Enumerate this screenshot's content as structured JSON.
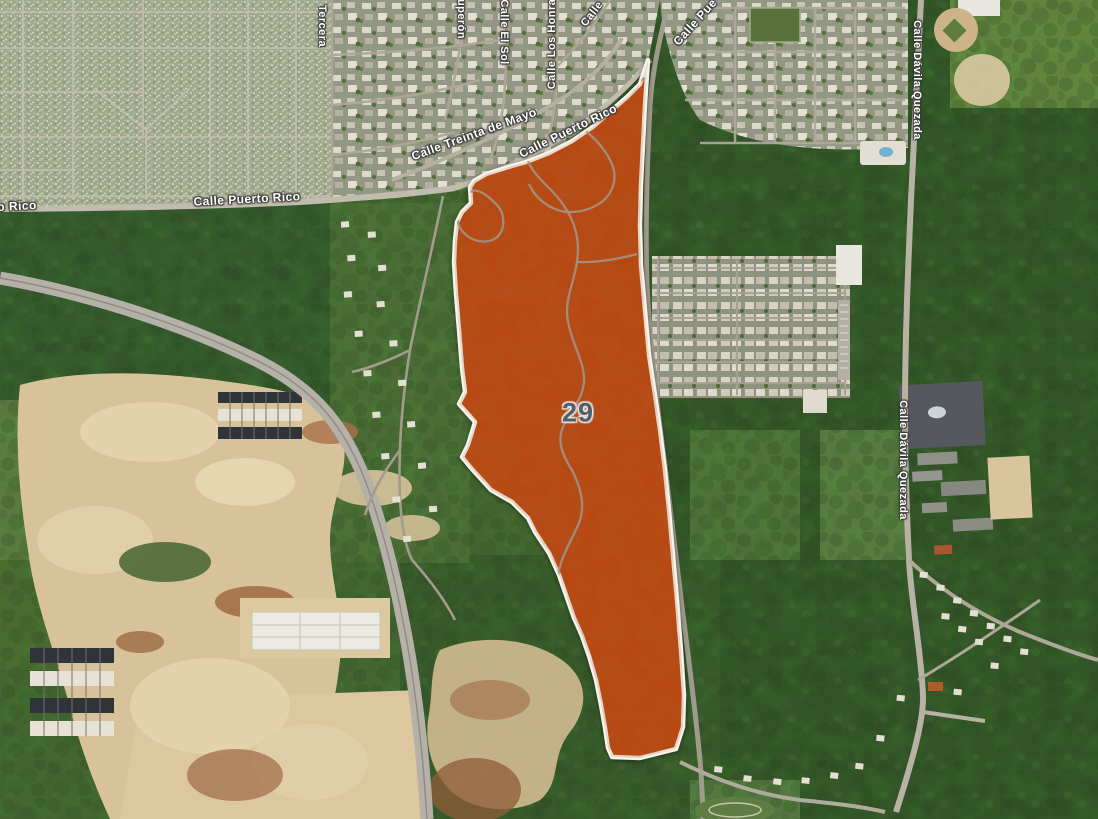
{
  "map": {
    "type": "satellite-parcel-view",
    "parcel": {
      "number": "29",
      "fill_color": "#bf450f",
      "border_color": "#f6f4ee",
      "number_color": "#51606e",
      "label_pos": {
        "x": 578,
        "y": 413
      },
      "outline": [
        [
          648,
          60
        ],
        [
          640,
          84
        ],
        [
          628,
          96
        ],
        [
          612,
          110
        ],
        [
          594,
          126
        ],
        [
          572,
          141
        ],
        [
          549,
          153
        ],
        [
          526,
          162
        ],
        [
          505,
          168
        ],
        [
          486,
          174
        ],
        [
          474,
          181
        ],
        [
          470,
          187
        ],
        [
          471,
          203
        ],
        [
          462,
          212
        ],
        [
          457,
          222
        ],
        [
          455,
          240
        ],
        [
          454,
          262
        ],
        [
          456,
          294
        ],
        [
          459,
          330
        ],
        [
          462,
          368
        ],
        [
          465,
          392
        ],
        [
          459,
          404
        ],
        [
          475,
          422
        ],
        [
          468,
          445
        ],
        [
          462,
          457
        ],
        [
          471,
          468
        ],
        [
          491,
          490
        ],
        [
          512,
          502
        ],
        [
          528,
          518
        ],
        [
          535,
          532
        ],
        [
          549,
          553
        ],
        [
          559,
          575
        ],
        [
          566,
          595
        ],
        [
          574,
          618
        ],
        [
          582,
          636
        ],
        [
          589,
          656
        ],
        [
          596,
          680
        ],
        [
          601,
          705
        ],
        [
          605,
          728
        ],
        [
          608,
          748
        ],
        [
          612,
          757
        ],
        [
          640,
          758
        ],
        [
          676,
          749
        ],
        [
          683,
          727
        ],
        [
          684,
          695
        ],
        [
          681,
          650
        ],
        [
          677,
          600
        ],
        [
          673,
          555
        ],
        [
          669,
          510
        ],
        [
          665,
          470
        ],
        [
          660,
          430
        ],
        [
          655,
          395
        ],
        [
          649,
          355
        ],
        [
          645,
          310
        ],
        [
          641,
          265
        ],
        [
          640,
          225
        ],
        [
          641,
          185
        ],
        [
          643,
          145
        ],
        [
          645,
          105
        ]
      ]
    },
    "street_labels": [
      {
        "text": "o Rico",
        "x": 17,
        "y": 206,
        "rotate": -3,
        "size": 12
      },
      {
        "text": "Calle Puerto Rico",
        "x": 247,
        "y": 199,
        "rotate": -3,
        "size": 12
      },
      {
        "text": "Tercera",
        "x": 322,
        "y": 26,
        "rotate": 90,
        "size": 11
      },
      {
        "text": "uperón",
        "x": 461,
        "y": 19,
        "rotate": 90,
        "size": 11
      },
      {
        "text": "Calle El Sol",
        "x": 504,
        "y": 32,
        "rotate": 90,
        "size": 11
      },
      {
        "text": "Calle Los Honra",
        "x": 552,
        "y": 44,
        "rotate": -90,
        "size": 11
      },
      {
        "text": "Calle",
        "x": 592,
        "y": 14,
        "rotate": -52,
        "size": 11
      },
      {
        "text": "Calle Treinta de Mayo",
        "x": 474,
        "y": 134,
        "rotate": -20,
        "size": 12
      },
      {
        "text": "Calle Puerto Rico",
        "x": 568,
        "y": 131,
        "rotate": -26,
        "size": 12
      },
      {
        "text": "Calle Pue",
        "x": 695,
        "y": 22,
        "rotate": -48,
        "size": 12
      },
      {
        "text": "Calle Dávila Quezada",
        "x": 917,
        "y": 80,
        "rotate": 90,
        "size": 11
      },
      {
        "text": "Calle Dávila Quezada",
        "x": 903,
        "y": 460,
        "rotate": 90,
        "size": 11
      }
    ]
  }
}
